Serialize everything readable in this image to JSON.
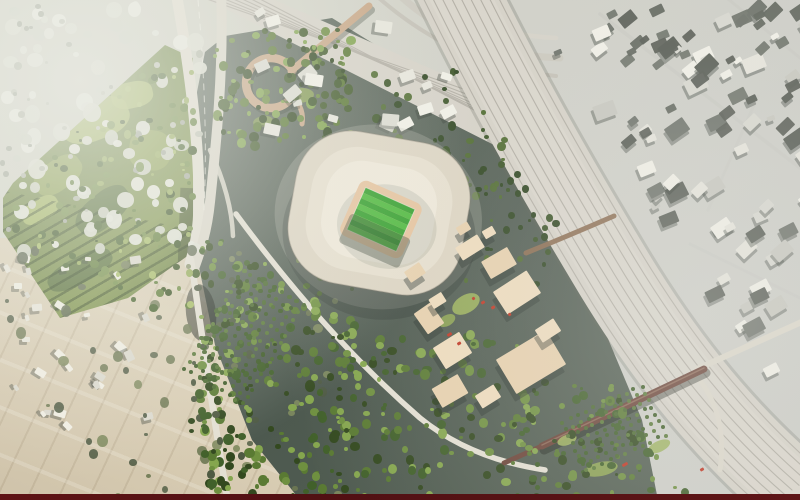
{
  "scene": {
    "type": "aerial-masterplan-rendering",
    "palette": {
      "rail_band": "#d6d2c8",
      "rail_line": "#b2aea4",
      "road": "#e4e0d3",
      "road2": "#dcd8cb",
      "park_base": "#7d9348",
      "park_light": "#a8bc60",
      "park_light2": "#8da24e",
      "park_dark": "#4c6631",
      "roof_outer": "#ddd5c3",
      "roof_mid": "#e7e0cf",
      "roof_bowl": "#efe9da",
      "track": "#e6c39d",
      "pitch1": "#2f9e28",
      "pitch2": "#49b838",
      "block": "#efdcbd",
      "block2": "#e8d1ae",
      "bridge_dark": "#6b4337",
      "bridge_tan": "#c8a685",
      "red": "#c03522"
    },
    "stadium": {
      "cx": 379,
      "cy": 213,
      "rotation": 10,
      "pitch_rotation": 14,
      "stripes": {
        "count": 8,
        "x": -27,
        "y": -23,
        "w": 54,
        "h": 46
      }
    },
    "rails": {
      "offsets": [
        -34,
        -25.5,
        -17,
        -8.5,
        0,
        8.5,
        17,
        25.5,
        34
      ],
      "ux": -0.835,
      "uy": 0.55
    },
    "fan": {
      "count": 7,
      "p0": [
        204,
        -2
      ],
      "p1": [
        472,
        92
      ],
      "step0": [
        9,
        0
      ],
      "step1": [
        10,
        8
      ]
    },
    "blocks": [
      [
        470,
        247,
        26,
        15,
        -32
      ],
      [
        499,
        263,
        30,
        20,
        -30
      ],
      [
        517,
        292,
        40,
        27,
        -33
      ],
      [
        429,
        318,
        20,
        25,
        -35
      ],
      [
        452,
        350,
        31,
        25,
        -32
      ],
      [
        531,
        362,
        58,
        40,
        -31
      ],
      [
        548,
        330,
        22,
        15,
        -33
      ],
      [
        450,
        391,
        30,
        22,
        -30
      ],
      [
        488,
        396,
        22,
        15,
        -32
      ],
      [
        415,
        272,
        18,
        13,
        -34
      ],
      [
        437,
        300,
        15,
        11,
        -32
      ],
      [
        463,
        228,
        13,
        9,
        -31
      ],
      [
        489,
        232,
        12,
        9,
        -30
      ]
    ],
    "red_accents": [
      [
        481,
        301,
        4,
        3
      ],
      [
        491,
        306,
        4,
        2.5
      ],
      [
        472,
        297,
        3,
        3
      ],
      [
        447,
        333,
        5,
        3
      ],
      [
        457,
        342,
        4,
        2.5
      ],
      [
        622,
        463,
        6,
        3
      ],
      [
        700,
        468,
        4,
        3
      ],
      [
        508,
        313,
        3,
        2.5
      ]
    ],
    "lawn_patches": [
      [
        466,
        304,
        30,
        18,
        -30,
        "#9fb659"
      ],
      [
        447,
        320,
        18,
        11,
        -30,
        "#8fa850"
      ],
      [
        601,
        469,
        34,
        14,
        -12,
        "#93ac52"
      ],
      [
        659,
        446,
        24,
        11,
        -25,
        "#9ab158"
      ],
      [
        300,
        95,
        28,
        15,
        -5,
        "#87a04e"
      ],
      [
        263,
        121,
        20,
        11,
        -10,
        "#7e974a"
      ],
      [
        567,
        440,
        20,
        10,
        -20,
        "#a3b95f"
      ]
    ],
    "park_patches": [
      [
        95,
        80,
        70,
        40,
        -20,
        "park_light"
      ],
      [
        58,
        135,
        52,
        30,
        -35,
        "park_light2"
      ],
      [
        132,
        55,
        42,
        26,
        -12,
        "park_light"
      ],
      [
        103,
        170,
        62,
        32,
        -40,
        "park_dark"
      ],
      [
        150,
        110,
        42,
        40,
        8,
        "park_light2"
      ],
      [
        40,
        170,
        40,
        22,
        -30,
        "park_light"
      ],
      [
        80,
        230,
        70,
        26,
        -28,
        "park_dark"
      ]
    ],
    "orchards": [
      {
        "seed": 31,
        "origin": [
          242,
          268
        ],
        "u": [
          7.4,
          4.4
        ],
        "v": [
          -4.6,
          7.6
        ],
        "cols": 9,
        "rows": 14,
        "r": 2.1,
        "jitter": 1.3,
        "colors": [
          "#4c6a31",
          "#3f5c28",
          "#5b7a3a"
        ]
      },
      {
        "seed": 32,
        "origin": [
          560,
          420
        ],
        "u": [
          8,
          -3.6
        ],
        "v": [
          3.4,
          7
        ],
        "cols": 11,
        "rows": 8,
        "r": 2.0,
        "jitter": 1.2,
        "colors": [
          "#4c6a31",
          "#41602a",
          "#5b7a3a"
        ]
      }
    ],
    "speckle_groups": [
      {
        "name": "city-topleft-light",
        "seed": 11,
        "count": 85,
        "region": [
          0,
          0,
          205,
          245
        ],
        "r": [
          3,
          9
        ],
        "shape": "blob",
        "colors": [
          "#e7e9df",
          "#dfe2d5",
          "#d2d6c8",
          "#edeee5"
        ],
        "opacity": 0.95
      },
      {
        "name": "city-topleft-dark",
        "seed": 12,
        "count": 40,
        "region": [
          0,
          0,
          205,
          245
        ],
        "r": [
          1.5,
          4
        ],
        "shape": "blob",
        "colors": [
          "#b4b9aa",
          "#a3a99b",
          "#c0c4b6"
        ]
      },
      {
        "name": "village-bottomleft",
        "seed": 13,
        "count": 30,
        "region": [
          2,
          250,
          145,
          175
        ],
        "r": [
          2.5,
          5.5
        ],
        "shape": "rect",
        "colors": [
          "#f1efe4",
          "#e9e7db",
          "#dcdacf"
        ],
        "shadow": true,
        "rot": [
          -15,
          75
        ]
      },
      {
        "name": "rural-trees",
        "seed": 14,
        "count": 65,
        "region": [
          0,
          245,
          335,
          250
        ],
        "r": [
          2,
          5.5
        ],
        "shape": "blob",
        "colors": [
          "#6d7852",
          "#5a654b",
          "#7e8a5e",
          "#4f5a42"
        ],
        "opacity": 0.9
      },
      {
        "name": "park-trees",
        "seed": 15,
        "count": 120,
        "region": [
          8,
          48,
          186,
          265
        ],
        "r": [
          1.5,
          4.5
        ],
        "shape": "blob",
        "colors": [
          "#44602a",
          "#5c7a34",
          "#375020",
          "#6f8c42"
        ],
        "halfplanes": [
          [
            138,
            152,
            -29610
          ],
          [
            -1,
            0,
            192
          ],
          [
            66,
            -125,
            28802
          ]
        ]
      },
      {
        "name": "park-meadow-speckle",
        "seed": 16,
        "count": 45,
        "region": [
          8,
          48,
          186,
          265
        ],
        "r": [
          1.5,
          3.5
        ],
        "shape": "blob",
        "colors": [
          "#a6bd63",
          "#93ab55"
        ],
        "halfplanes": [
          [
            138,
            152,
            -29610
          ],
          [
            -1,
            0,
            192
          ],
          [
            66,
            -125,
            28802
          ]
        ]
      },
      {
        "name": "north-site-trees",
        "seed": 17,
        "count": 130,
        "region": [
          212,
          24,
          135,
          120
        ],
        "r": [
          1.8,
          5
        ],
        "shape": "blob",
        "colors": [
          "#3d5626",
          "#55742f",
          "#2c421c",
          "#69893c",
          "#7ea24a"
        ]
      },
      {
        "name": "plaza-trees",
        "seed": 18,
        "count": 55,
        "region": [
          300,
          60,
          235,
          135
        ],
        "r": [
          1.8,
          4.5
        ],
        "shape": "blob",
        "colors": [
          "#3a5326",
          "#4f6b30",
          "#2e4520"
        ],
        "halfplanes": [
          [
            -480,
            335,
            195500
          ]
        ]
      },
      {
        "name": "southwest-band-trees",
        "seed": 19,
        "count": 230,
        "region": [
          196,
          238,
          155,
          262
        ],
        "r": [
          1.8,
          5.2
        ],
        "shape": "blob",
        "colors": [
          "#41602a",
          "#5a7a33",
          "#33491f",
          "#6f9040",
          "#85a64e"
        ]
      },
      {
        "name": "mid-south-trees",
        "seed": 20,
        "count": 150,
        "region": [
          335,
          330,
          200,
          170
        ],
        "r": [
          1.8,
          5
        ],
        "shape": "blob",
        "colors": [
          "#41602a",
          "#5a7a33",
          "#33491f",
          "#6f9040",
          "#85a64e"
        ]
      },
      {
        "name": "railside-trees",
        "seed": 21,
        "count": 60,
        "region": [
          430,
          118,
          125,
          165
        ],
        "r": [
          1.5,
          4
        ],
        "shape": "blob",
        "colors": [
          "#3a5326",
          "#2e4520",
          "#4f6b30"
        ],
        "halfplanes": [
          [
            -480,
            335,
            195500
          ]
        ]
      },
      {
        "name": "east-bottom-trees",
        "seed": 22,
        "count": 100,
        "region": [
          520,
          378,
          175,
          122
        ],
        "r": [
          1.8,
          5
        ],
        "shape": "blob",
        "colors": [
          "#41602a",
          "#5a7a33",
          "#33491f",
          "#6f9040"
        ],
        "halfplanes": [
          [
            -480,
            335,
            165500
          ]
        ]
      },
      {
        "name": "roadside-trees",
        "seed": 26,
        "count": 46,
        "region": [
          186,
          255,
          60,
          245
        ],
        "r": [
          2,
          4.5
        ],
        "shape": "blob",
        "colors": [
          "#4f5a42",
          "#41602a",
          "#33491f"
        ]
      },
      {
        "name": "top-center-buildings",
        "seed": 23,
        "count": 22,
        "region": [
          240,
          8,
          275,
          118
        ],
        "r": [
          3.5,
          8
        ],
        "shape": "rect",
        "colors": [
          "#f2f1e8",
          "#e8e7dd",
          "#dcdcd2"
        ],
        "shadow": true,
        "rot": [
          -40,
          30
        ],
        "halfplanes": [
          [
            -480,
            335,
            195500
          ]
        ]
      },
      {
        "name": "urban-right-buildings",
        "seed": 24,
        "count": 120,
        "region": [
          505,
          0,
          295,
          500
        ],
        "r": [
          3.5,
          10
        ],
        "shape": "rect",
        "colors": [
          "#f1f0e7",
          "#e6e5dc",
          "#d8d8d0",
          "#6e736b",
          "#585d55",
          "#c8c8c0"
        ],
        "shadow": true,
        "rot": [
          -45,
          -20
        ],
        "halfplanes": [
          [
            480,
            -335,
            -242300
          ]
        ]
      },
      {
        "name": "topright-dark-buildings",
        "seed": 25,
        "count": 30,
        "region": [
          600,
          0,
          200,
          130
        ],
        "r": [
          3.5,
          8.5
        ],
        "shape": "rect",
        "colors": [
          "#60655d",
          "#6d7269",
          "#565b53"
        ],
        "rot": [
          -45,
          -20
        ],
        "opacity": 0.95
      }
    ]
  }
}
